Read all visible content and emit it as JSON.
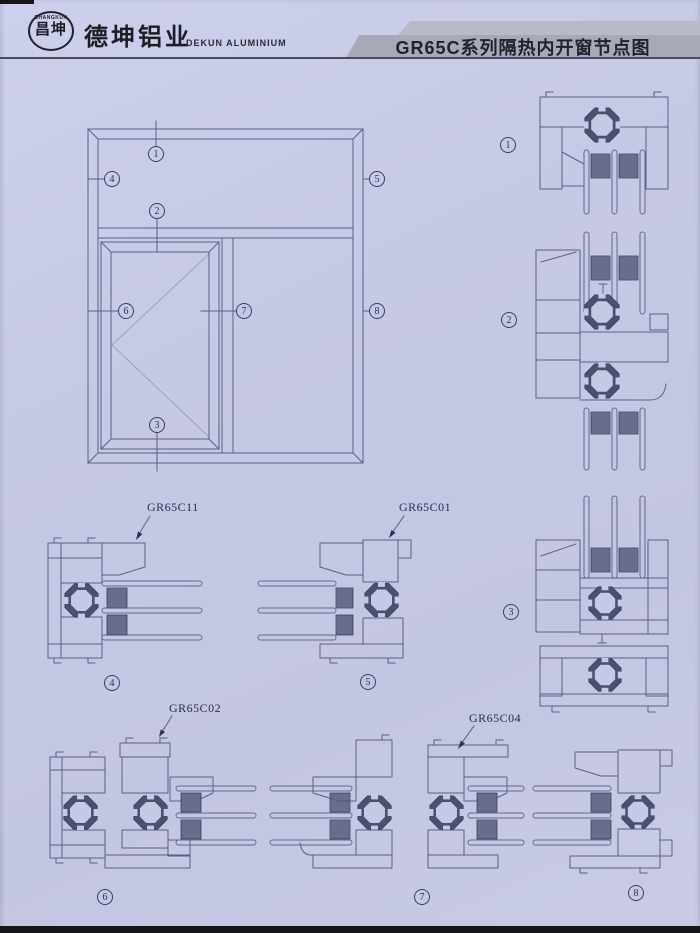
{
  "header": {
    "logo_badge_top": "CHANGKUN",
    "logo_badge_cn": "昌坤",
    "company_cn": "德坤铝业",
    "company_en": "DEKUN ALUMINIUM",
    "title": "GR65C系列隔热内开窗节点图"
  },
  "marker_digits": [
    "1",
    "2",
    "3",
    "4",
    "5",
    "6",
    "7",
    "8"
  ],
  "profile_labels": {
    "d4": "GR65C11",
    "d5": "GR65C01",
    "d6": "GR65C02",
    "d7": "GR65C04"
  },
  "colors": {
    "background": "#c6c9e5",
    "line": "#5a5f84",
    "dark_fill": "#4b5070",
    "title_bar": "#a7a9b9",
    "title_text": "#222228",
    "header_rule": "#4b4c5b",
    "page_edge": "#15151a"
  }
}
